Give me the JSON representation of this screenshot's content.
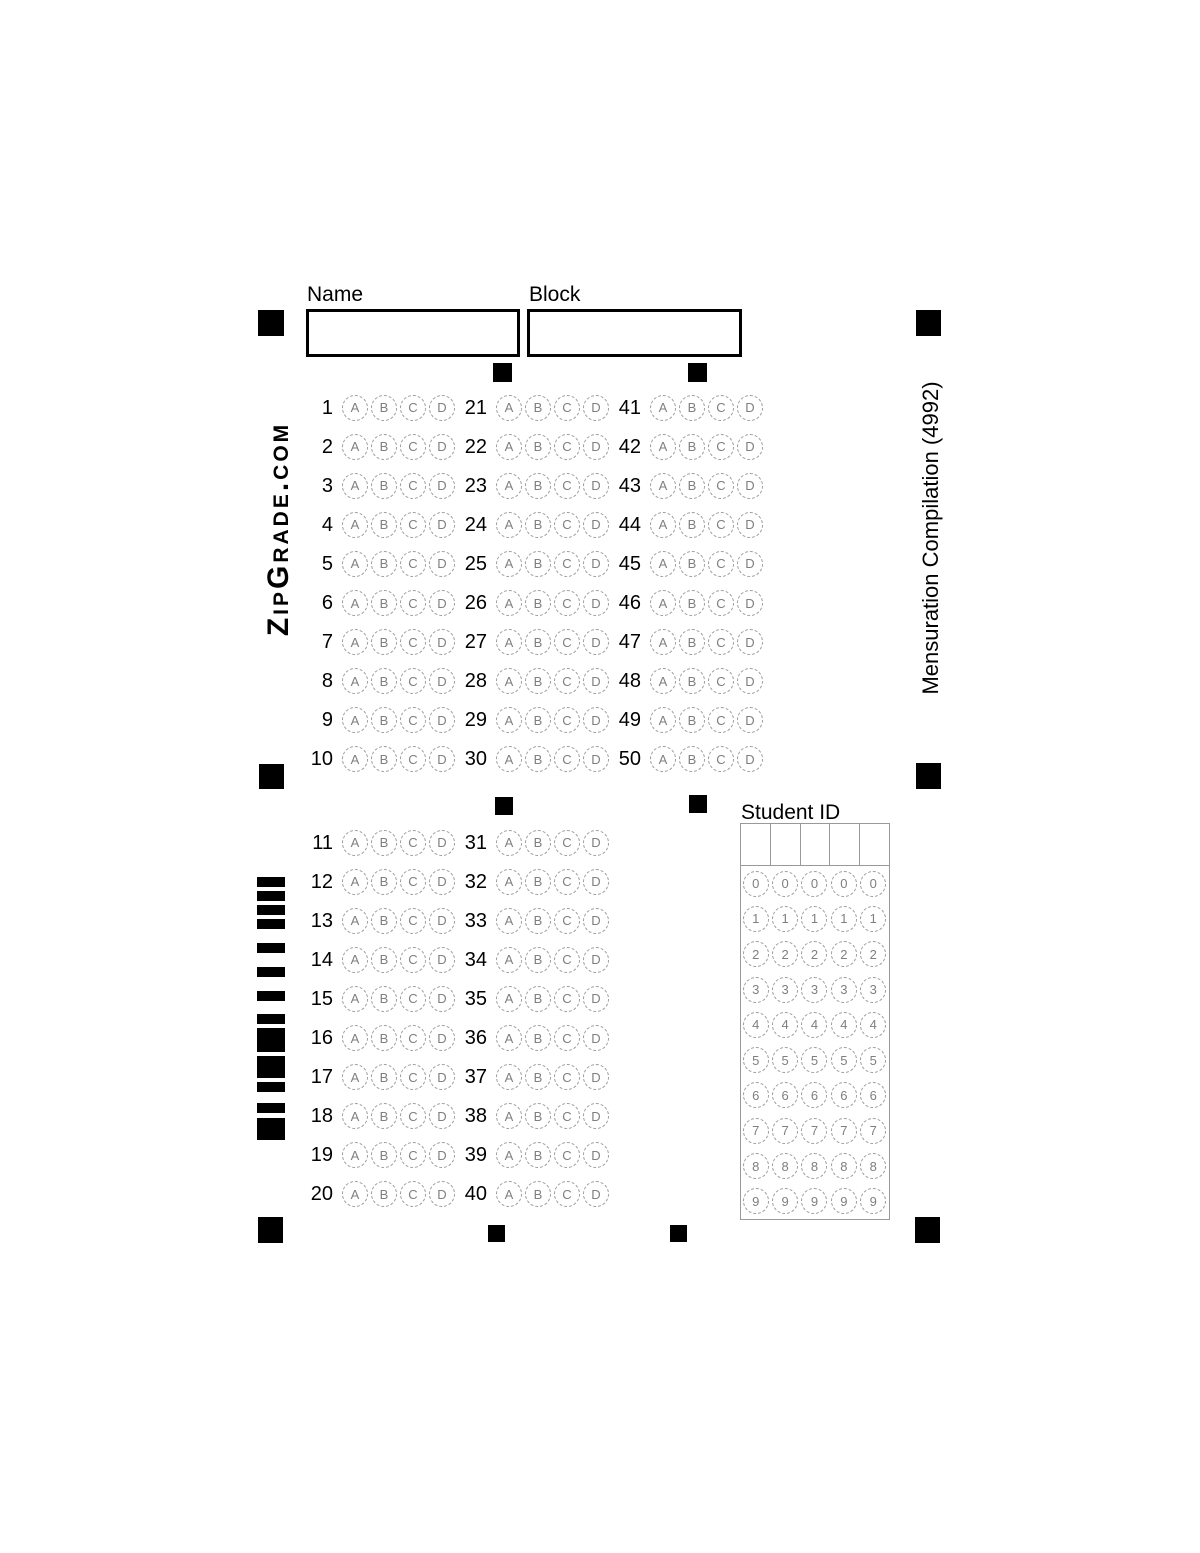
{
  "branding": {
    "logo_text": "ZipGrade.com"
  },
  "quiz": {
    "title_vertical": "Mensuration Compilation (4992)"
  },
  "header": {
    "name_label": "Name",
    "name_value": "",
    "block_label": "Block",
    "block_value": ""
  },
  "answer_options": [
    "A",
    "B",
    "C",
    "D"
  ],
  "answer_sections": [
    {
      "rows": [
        [
          1,
          21,
          41
        ],
        [
          2,
          22,
          42
        ],
        [
          3,
          23,
          43
        ],
        [
          4,
          24,
          44
        ],
        [
          5,
          25,
          45
        ],
        [
          6,
          26,
          46
        ],
        [
          7,
          27,
          47
        ],
        [
          8,
          28,
          48
        ],
        [
          9,
          29,
          49
        ],
        [
          10,
          30,
          50
        ]
      ]
    },
    {
      "rows": [
        [
          11,
          31
        ],
        [
          12,
          32
        ],
        [
          13,
          33
        ],
        [
          14,
          34
        ],
        [
          15,
          35
        ],
        [
          16,
          36
        ],
        [
          17,
          37
        ],
        [
          18,
          38
        ],
        [
          19,
          39
        ],
        [
          20,
          40
        ]
      ]
    }
  ],
  "student_id": {
    "label": "Student ID",
    "columns": 5,
    "digits": [
      "0",
      "1",
      "2",
      "3",
      "4",
      "5",
      "6",
      "7",
      "8",
      "9"
    ],
    "value": ""
  },
  "barcode": {
    "bars": [
      {
        "h": 10,
        "gap": 4
      },
      {
        "h": 10,
        "gap": 4
      },
      {
        "h": 10,
        "gap": 4
      },
      {
        "h": 10,
        "gap": 14
      },
      {
        "h": 10,
        "gap": 14
      },
      {
        "h": 10,
        "gap": 14
      },
      {
        "h": 10,
        "gap": 13
      },
      {
        "h": 10,
        "gap": 4
      },
      {
        "h": 24,
        "gap": 4
      },
      {
        "h": 22,
        "gap": 4
      },
      {
        "h": 10,
        "gap": 11
      },
      {
        "h": 10,
        "gap": 5
      },
      {
        "h": 22,
        "gap": 0
      }
    ]
  },
  "colors": {
    "mark": "#000000",
    "bubble_outline": "#9b9b9b",
    "bubble_text": "#7f7f7f",
    "grid_line": "#999999"
  }
}
